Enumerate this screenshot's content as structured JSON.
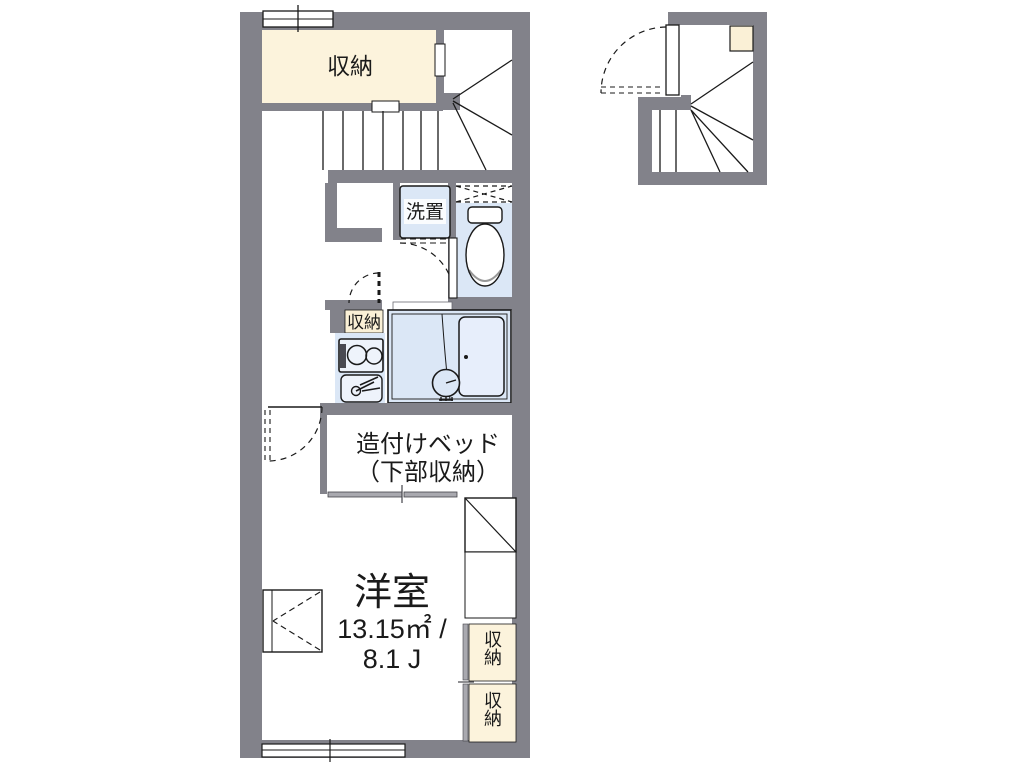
{
  "colors": {
    "wall": "#82828a",
    "cream": "#fcf3dc",
    "cream_small": "#faf0d6",
    "blue": "#dbe7f6",
    "tub": "#e7eefb",
    "line": "#1a1a1a"
  },
  "floor_plan": {
    "storage_top": {
      "label": "収納"
    },
    "washer": {
      "label": "洗置"
    },
    "storage_small": {
      "label": "収納"
    },
    "built_in_bed": {
      "line1": "造付けベッド",
      "line2": "（下部収納）"
    },
    "main_room": {
      "name": "洋室",
      "area_sqm": "13.15㎡ /",
      "area_jo": "8.1 J"
    },
    "closet_right_upper": {
      "label": "収納"
    },
    "closet_right_lower": {
      "label": "収納"
    }
  }
}
